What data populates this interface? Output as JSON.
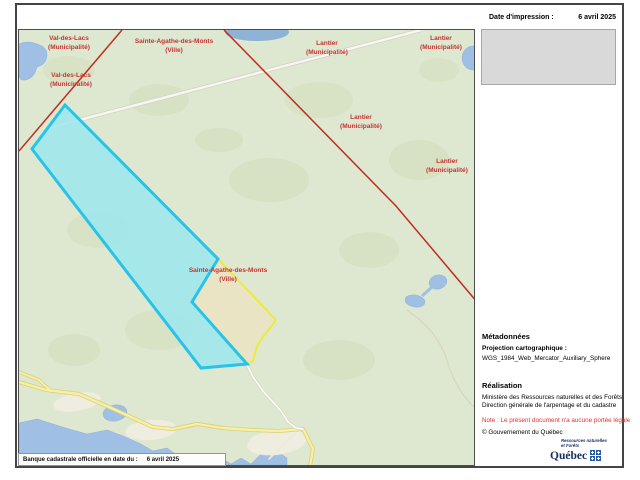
{
  "header": {
    "date_label": "Date d'impression :",
    "date_value": "6 avril 2025"
  },
  "map": {
    "labels": [
      {
        "name": "Val-des-Lacs",
        "type": "(Municipalité)"
      },
      {
        "name": "Val-des-Lacs",
        "type": "(Municipalité)"
      },
      {
        "name": "Sainte-Agathe-des-Monts",
        "type": "(Ville)"
      },
      {
        "name": "Lantier",
        "type": "(Municipalité)"
      },
      {
        "name": "Lantier",
        "type": "(Municipalité)"
      },
      {
        "name": "Lantier",
        "type": "(Municipalité)"
      },
      {
        "name": "Lantier",
        "type": "(Municipalité)"
      },
      {
        "name": "Sainte-Agathe-des-Monts",
        "type": "(Ville)"
      }
    ],
    "footer_bar": {
      "label": "Banque cadastrale officielle en date du :",
      "value": "6 avril 2025"
    },
    "colors": {
      "background_green": "#dee7cf",
      "municipal_boundary_red": "#bf2d22",
      "label_red": "#c53434",
      "selected_parcel_fill": "#9ce7ef",
      "selected_parcel_border": "#29c2e8",
      "adjacent_parcel_fill": "#e9e5c4",
      "adjacent_parcel_border": "#eeeb31",
      "water_blue": "#9fc0e4",
      "road_yellow": "#f6f0a0"
    }
  },
  "panel": {
    "metadata_title": "Métadonnées",
    "projection_label": "Projection cartographique :",
    "projection_value": "WGS_1984_Web_Mercator_Auxiliary_Sphere",
    "realisation_title": "Réalisation",
    "realisation_line1": "Ministère des Ressources naturelles et des Forêts",
    "realisation_line2": "Direction générale de l'arpentage et du cadastre",
    "note": "Note : Le présent document n'a aucune portée légale",
    "copyright": "© Gouvernement du Québec",
    "logo": {
      "small_text": "Ressources naturelles\net Forêts",
      "wordmark": "Québec"
    }
  }
}
